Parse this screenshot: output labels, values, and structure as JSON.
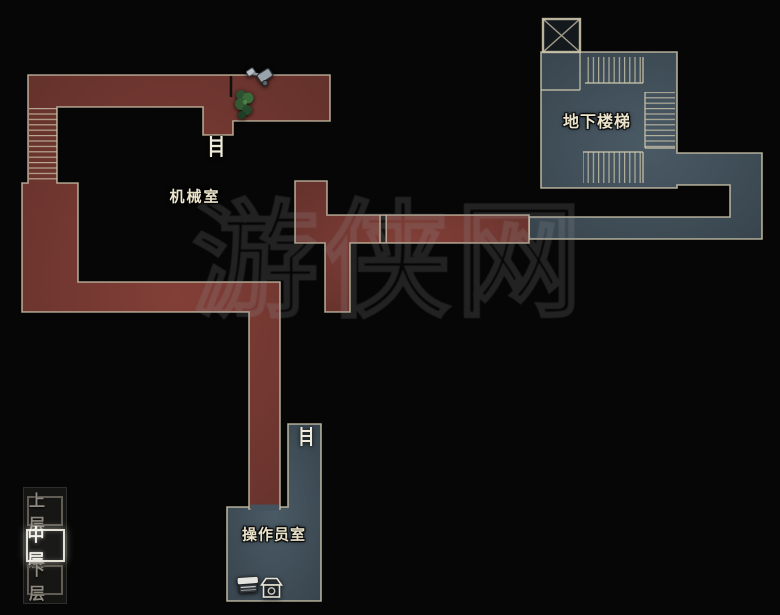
{
  "map": {
    "title_context": "floor map",
    "rooms": [
      {
        "id": "machine-room",
        "label": "机械室"
      },
      {
        "id": "basement-stairs",
        "label": "地下楼梯"
      },
      {
        "id": "operator-room",
        "label": "操作员室"
      }
    ]
  },
  "floor_selector": {
    "options": [
      {
        "label": "上层",
        "selected": false
      },
      {
        "label": "中层",
        "selected": true
      },
      {
        "label": "下层",
        "selected": false
      }
    ],
    "selected_label": "中层"
  },
  "watermark": {
    "text": "游侠网"
  },
  "icons": {
    "list": [
      "ladder-icon (machine room)",
      "ladder-icon (operator room)",
      "elevator-icon",
      "plant-icon",
      "mower-item-icon",
      "tape-recorder-save-icon",
      "item-box-icon"
    ]
  },
  "colors": {
    "background": "#060606",
    "corridor_red": "#7b3a32",
    "room_blue": "#44535e",
    "outline_beige": "#cdc5ab",
    "selected_floor_text": "#f3f1e9",
    "dim_floor_text": "#8e8a80",
    "label_text": "#ebe4cb"
  }
}
